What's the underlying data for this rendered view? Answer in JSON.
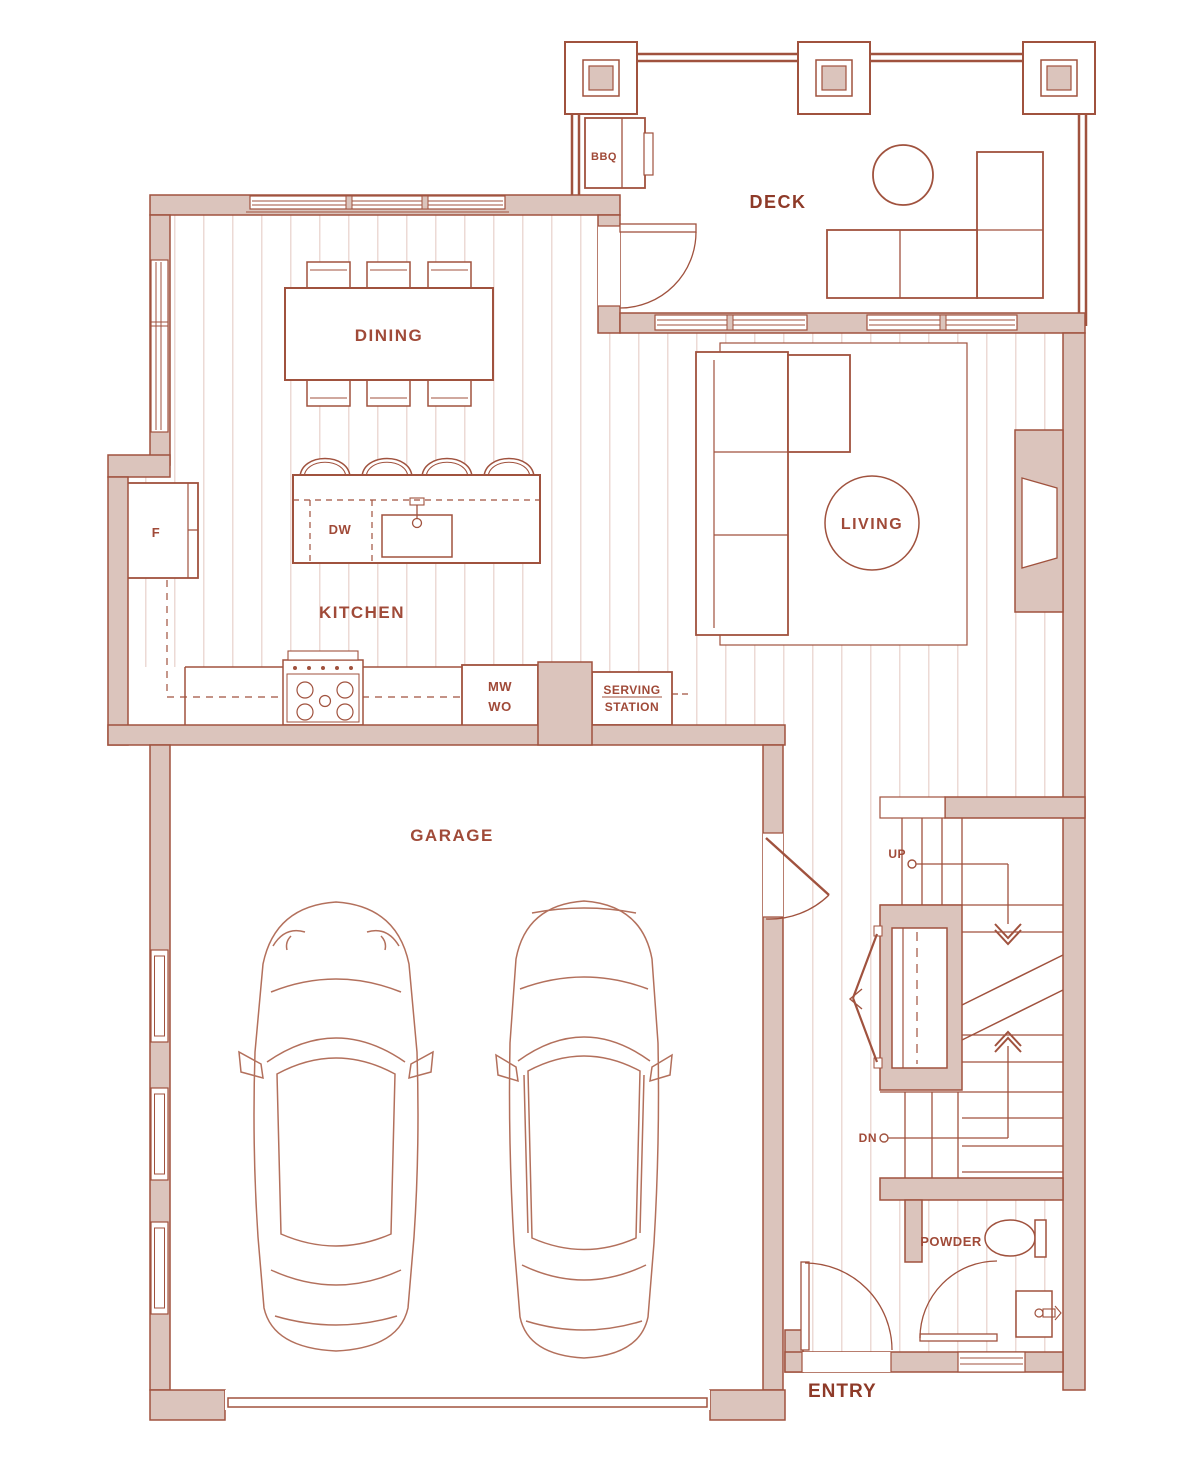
{
  "floorplan": {
    "rooms": {
      "deck": "DECK",
      "dining": "DINING",
      "kitchen": "KITCHEN",
      "living": "LIVING",
      "garage": "GARAGE",
      "powder": "POWDER",
      "entry": "ENTRY"
    },
    "fixtures": {
      "bbq": "BBQ",
      "fridge": "F",
      "dishwasher": "DW",
      "microwave": "MW",
      "wall_oven": "WO",
      "serving_station_line1": "SERVING",
      "serving_station_line2": "STATION"
    },
    "stairs": {
      "up": "UP",
      "down": "DN"
    },
    "colors": {
      "wall_fill": "#dbc4bc",
      "line": "#a0523e",
      "label": "#a04a38",
      "label_dark": "#8e3a28",
      "floor_hatch": "#ecdad5"
    }
  }
}
